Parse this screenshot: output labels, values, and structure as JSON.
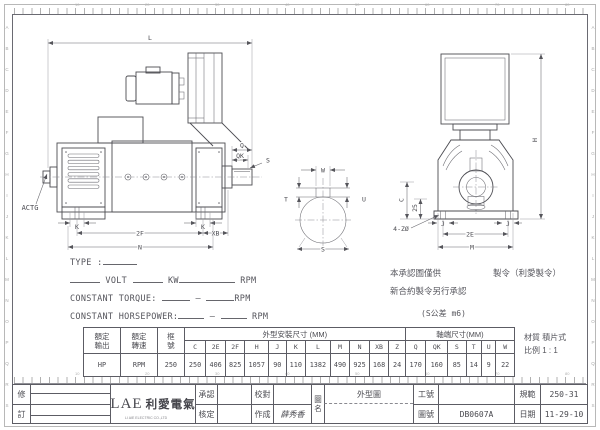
{
  "sheet": {
    "zones": [
      "A",
      "B",
      "C",
      "D",
      "E",
      "F",
      "G",
      "H",
      "I",
      "J",
      "K",
      "L",
      "M",
      "N",
      "O",
      "P",
      "Q",
      "R",
      "S"
    ],
    "ruler_numbers": [
      "10",
      "20",
      "30",
      "40",
      "50",
      "60",
      "70",
      "80"
    ]
  },
  "views": {
    "side": {
      "dim_l": "L",
      "dim_q": "Q",
      "dim_qk": "QK",
      "dim_s": "S",
      "dim_k": "K",
      "dim_2f": "2F",
      "dim_xb": "XB",
      "dim_n": "N",
      "label_actg": "ACTG"
    },
    "shaft_end": {
      "dim_w": "W",
      "dim_t": "T",
      "dim_u": "U",
      "dim_s": "S"
    },
    "front": {
      "dim_h": "H",
      "dim_c": "C",
      "dim_25": "25",
      "dim_holes": "4-ZØ",
      "dim_j": "J",
      "dim_2e": "2E",
      "dim_m": "M"
    }
  },
  "spec": {
    "type_label": "TYPE :",
    "volt": "VOLT",
    "kw": "KW",
    "rpm": "RPM",
    "ct_label": "CONSTANT TORQUE:",
    "chp_label": "CONSTANT HORSEPOWER:",
    "dash": "—"
  },
  "notes": {
    "line1_a": "本承認圖僅供",
    "line1_b": "製令（利愛製令）",
    "line2": "新合約製令另行承認",
    "tolerance": "(S公差 m6)",
    "material_label": "材質",
    "material_value": "積片式",
    "scale_label": "比例",
    "scale_value": "1 : 1"
  },
  "table": {
    "rated_output": "額定\n輸出",
    "rated_speed": "額定\n轉速",
    "frame_no": "框\n號",
    "group_mount": "外型安裝尺寸 (MM)",
    "group_shaft": "軸端尺寸(MM)",
    "mount_cols": [
      "C",
      "2E",
      "2F",
      "H",
      "J",
      "K",
      "L",
      "M",
      "N",
      "XB",
      "Z"
    ],
    "shaft_cols": [
      "Q",
      "QK",
      "S",
      "T",
      "U",
      "W"
    ],
    "output_value": "HP",
    "speed_value": "RPM",
    "frame_value": "250",
    "mount_values": [
      "250",
      "406",
      "825",
      "1057",
      "90",
      "110",
      "1382",
      "490",
      "925",
      "168",
      "24"
    ],
    "shaft_values": [
      "170",
      "160",
      "85",
      "14",
      "9",
      "22"
    ]
  },
  "titleblock": {
    "rev_top": "修",
    "rev_bottom": "訂",
    "logo_en": "LAE",
    "logo_cn": "利愛電氣",
    "logo_sub": "LI AIE ELECTRIC CO.,LTD",
    "approve_label": "承認",
    "approve_value": "",
    "check_label": "核定",
    "check_value": "",
    "proof_label": "校對",
    "proof_value": "",
    "made_label": "作成",
    "made_value": "薛秀香",
    "name_label": "圖\n名",
    "name_value": "外型圖",
    "work_label": "工號",
    "work_value": "",
    "dwg_label": "圖號",
    "dwg_value": "DB0607A",
    "spec_label": "規範",
    "spec_value": "250-31",
    "date_label": "日期",
    "date_value": "11-29-10"
  }
}
